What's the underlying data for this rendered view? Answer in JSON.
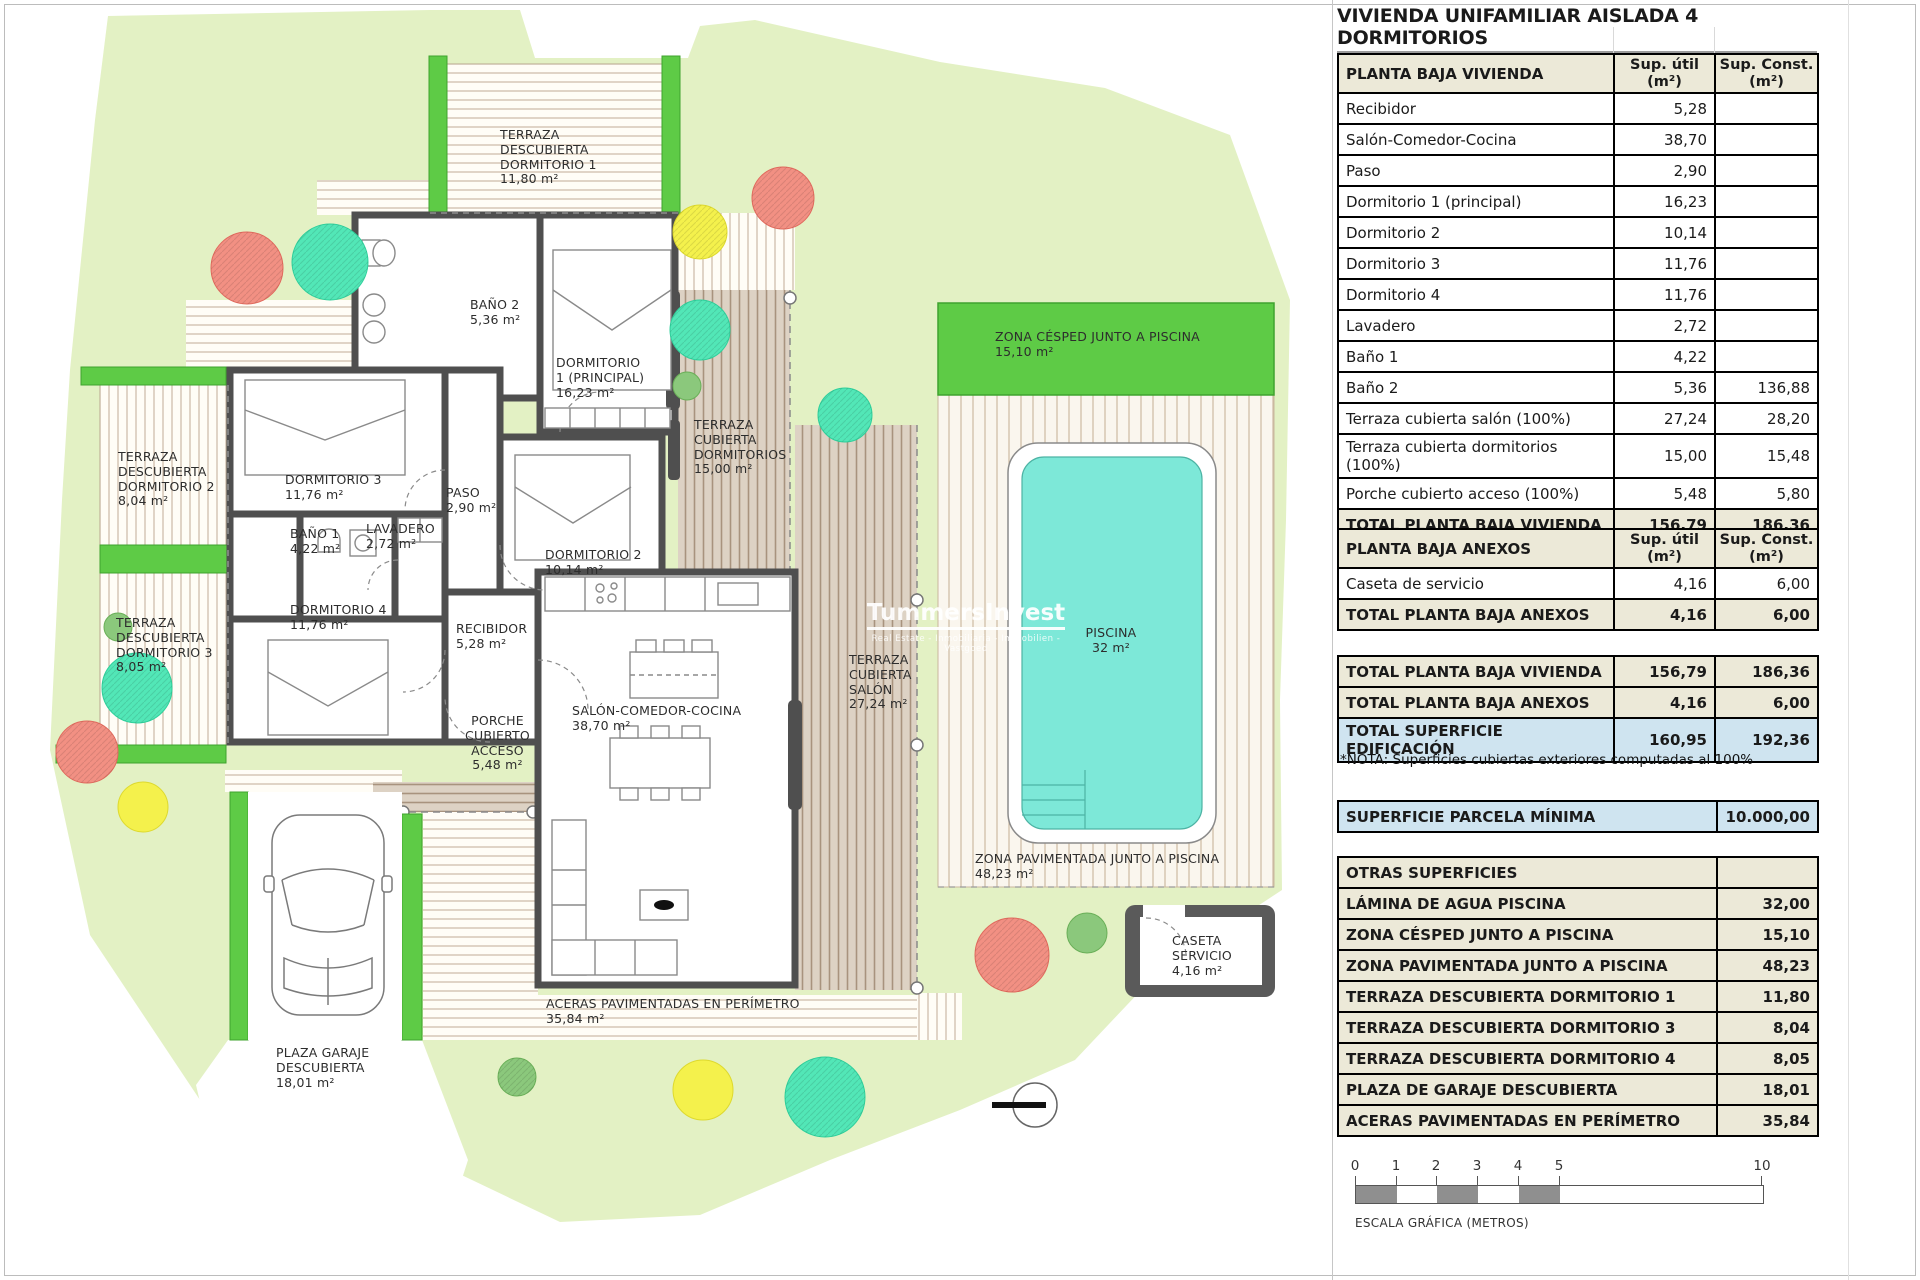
{
  "sheet": {
    "title": "VIVIENDA UNIFAMILIAR AISLADA 4 DORMITORIOS"
  },
  "columns": {
    "util": "Sup. útil\n(m²)",
    "const": "Sup. Const.\n(m²)"
  },
  "planta_baja_vivienda": {
    "header": "PLANTA BAJA VIVIENDA",
    "rows": [
      {
        "label": "Recibidor",
        "util": "5,28",
        "const": ""
      },
      {
        "label": "Salón-Comedor-Cocina",
        "util": "38,70",
        "const": ""
      },
      {
        "label": "Paso",
        "util": "2,90",
        "const": ""
      },
      {
        "label": "Dormitorio 1 (principal)",
        "util": "16,23",
        "const": ""
      },
      {
        "label": "Dormitorio 2",
        "util": "10,14",
        "const": ""
      },
      {
        "label": "Dormitorio 3",
        "util": "11,76",
        "const": ""
      },
      {
        "label": "Dormitorio 4",
        "util": "11,76",
        "const": ""
      },
      {
        "label": "Lavadero",
        "util": "2,72",
        "const": ""
      },
      {
        "label": "Baño 1",
        "util": "4,22",
        "const": ""
      },
      {
        "label": "Baño 2",
        "util": "5,36",
        "const": "136,88"
      },
      {
        "label": "Terraza cubierta salón (100%)",
        "util": "27,24",
        "const": "28,20"
      },
      {
        "label": "Terraza cubierta dormitorios (100%)",
        "util": "15,00",
        "const": "15,48"
      },
      {
        "label": "Porche cubierto acceso (100%)",
        "util": "5,48",
        "const": "5,80"
      }
    ],
    "total": {
      "label": "TOTAL PLANTA BAJA VIVIENDA",
      "util": "156,79",
      "const": "186,36"
    }
  },
  "planta_baja_anexos": {
    "header": "PLANTA BAJA ANEXOS",
    "rows": [
      {
        "label": "Caseta de servicio",
        "util": "4,16",
        "const": "6,00"
      }
    ],
    "total": {
      "label": "TOTAL PLANTA BAJA ANEXOS",
      "util": "4,16",
      "const": "6,00"
    }
  },
  "resumen": {
    "rows": [
      {
        "label": "TOTAL PLANTA BAJA VIVIENDA",
        "util": "156,79",
        "const": "186,36"
      },
      {
        "label": "TOTAL PLANTA BAJA ANEXOS",
        "util": "4,16",
        "const": "6,00"
      },
      {
        "label": "TOTAL SUPERFICIE EDIFICACIÓN",
        "util": "160,95",
        "const": "192,36"
      }
    ],
    "nota": "*NOTA: Superficies cubiertas exteriores computadas al 100%"
  },
  "parcela": {
    "label": "SUPERFICIE PARCELA MÍNIMA",
    "value": "10.000,00"
  },
  "otras_superficies": {
    "header": "OTRAS SUPERFICIES",
    "rows": [
      {
        "label": "LÁMINA DE AGUA PISCINA",
        "value": "32,00"
      },
      {
        "label": "ZONA CÉSPED JUNTO A PISCINA",
        "value": "15,10"
      },
      {
        "label": "ZONA PAVIMENTADA JUNTO A PISCINA",
        "value": "48,23"
      },
      {
        "label": "TERRAZA DESCUBIERTA DORMITORIO 1",
        "value": "11,80"
      },
      {
        "label": "TERRAZA DESCUBIERTA DORMITORIO 3",
        "value": "8,04"
      },
      {
        "label": "TERRAZA DESCUBIERTA DORMITORIO 4",
        "value": "8,05"
      },
      {
        "label": "PLAZA DE GARAJE DESCUBIERTA",
        "value": "18,01"
      },
      {
        "label": "ACERAS PAVIMENTADAS EN PERÍMETRO",
        "value": "35,84"
      }
    ]
  },
  "scale_bar": {
    "ticks": [
      "0",
      "1",
      "2",
      "3",
      "4",
      "5",
      "10"
    ],
    "caption": "ESCALA GRÁFICA (METROS)"
  },
  "watermark": {
    "name": "TummersInvest",
    "tagline": "Real Estate - Inmobiliaria - Immobilien - Vastgoed"
  },
  "plan_labels": {
    "terraza_desc_dorm1": "TERRAZA\nDESCUBIERTA\nDORMITORIO 1\n11,80 m²",
    "bano2": "BAÑO 2\n5,36 m²",
    "dorm1": "DORMITORIO\n1 (PRINCIPAL)\n16,23 m²",
    "terraza_cub_dorms": "TERRAZA\nCUBIERTA\nDORMITORIOS\n15,00 m²",
    "terraza_desc_dorm2": "TERRAZA\nDESCUBIERTA\nDORMITORIO 2\n8,04 m²",
    "dorm3": "DORMITORIO 3\n11,76 m²",
    "paso": "PASO\n2,90 m²",
    "bano1": "BAÑO 1\n4,22 m²",
    "lavadero": "LAVADERO\n2,72 m²",
    "terraza_desc_dorm3": "TERRAZA\nDESCUBIERTA\nDORMITORIO 3\n8,05 m²",
    "dorm4": "DORMITORIO 4\n11,76 m²",
    "dorm2": "DORMITORIO 2\n10,14 m²",
    "recibidor": "RECIBIDOR\n5,28 m²",
    "salon": "SALÓN-COMEDOR-COCINA\n38,70 m²",
    "porche": "PORCHE\nCUBIERTO\nACCESO\n5,48 m²",
    "terraza_cub_salon": "TERRAZA\nCUBIERTA\nSALÓN\n27,24 m²",
    "zona_cesped": "ZONA CÉSPED JUNTO A PISCINA\n15,10 m²",
    "piscina": "PISCINA\n32 m²",
    "zona_pavimentada": "ZONA PAVIMENTADA JUNTO A PISCINA\n48,23 m²",
    "caseta": "CASETA\nSERVICIO\n4,16 m²",
    "plaza_garaje": "PLAZA GARAJE\nDESCUBIERTA\n18,01 m²",
    "aceras": "ACERAS PAVIMENTADAS EN PERÍMETRO\n35,84 m²"
  },
  "colors": {
    "parcel_green": "#e3f1c4",
    "hedge_green": "#5ecb46",
    "pool_water": "#7de8d8",
    "covered_beige": "#ddd2c4",
    "wall_gray": "#555555",
    "tree_red": "#f29083",
    "tree_teal": "#52e7b7",
    "tree_yellow": "#f4f14c",
    "tree_green": "#8bc87c",
    "table_beige": "#ece9d8",
    "table_blue": "#cfe4f0"
  }
}
